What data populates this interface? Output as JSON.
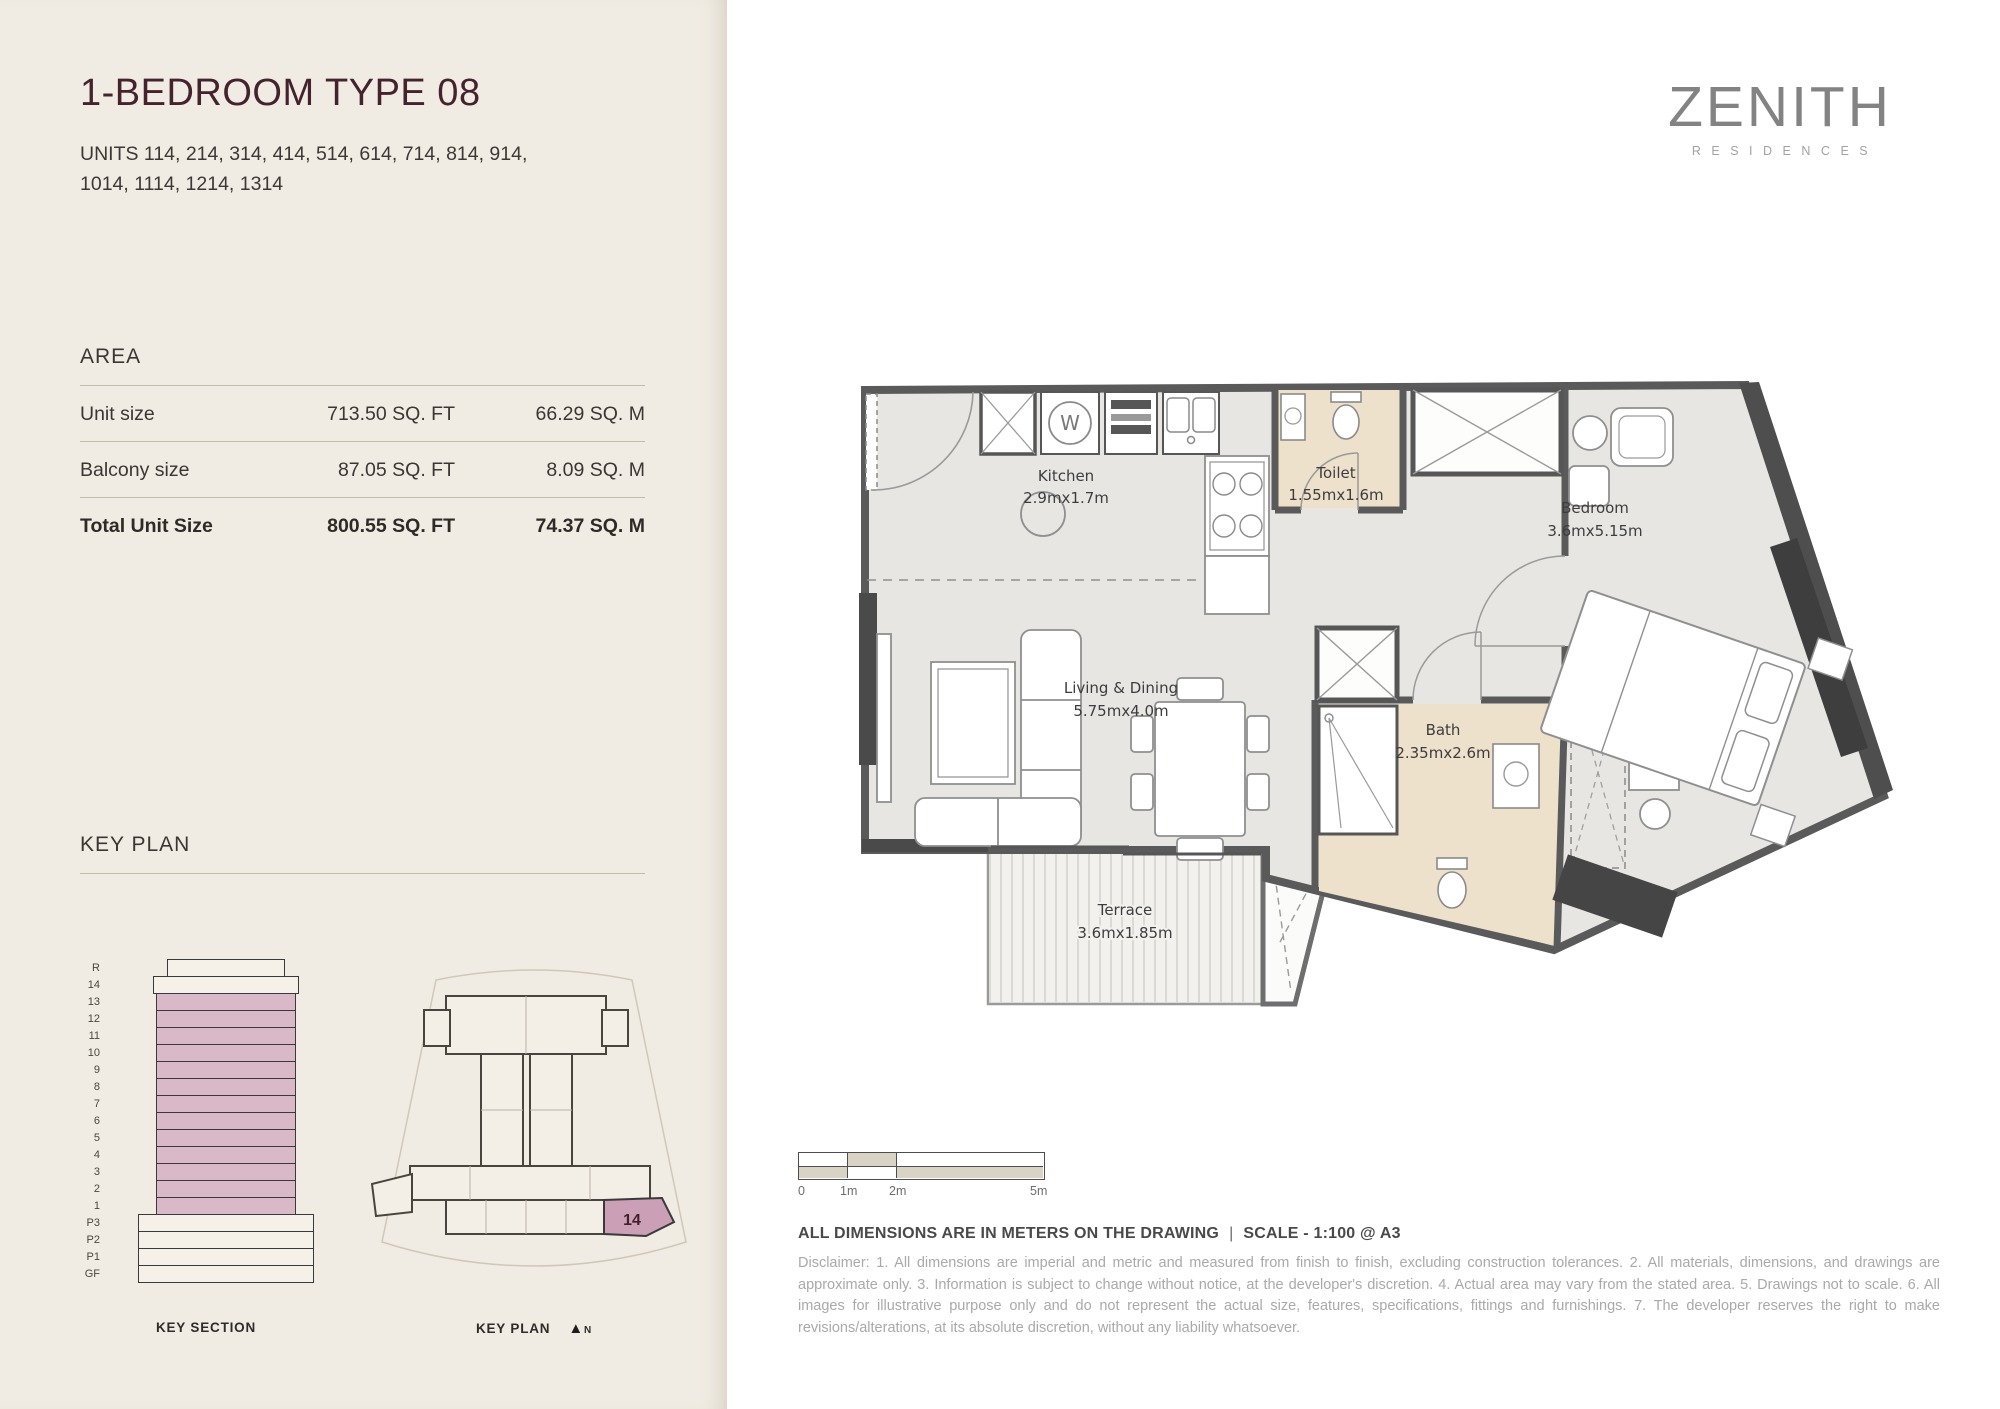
{
  "header": {
    "title": "1-BEDROOM TYPE 08",
    "units_line1": "UNITS 114, 214, 314, 414, 514, 614, 714, 814, 914,",
    "units_line2": "1014, 1114, 1214, 1314"
  },
  "brand": {
    "name": "ZENITH",
    "subtitle": "RESIDENCES"
  },
  "area": {
    "heading": "AREA",
    "rows": [
      {
        "label": "Unit size",
        "sqft": "713.50 SQ. FT",
        "sqm": "66.29 SQ. M"
      },
      {
        "label": "Balcony size",
        "sqft": "87.05 SQ. FT",
        "sqm": "8.09 SQ. M"
      },
      {
        "label": "Total Unit Size",
        "sqft": "800.55 SQ. FT",
        "sqm": "74.37 SQ. M"
      }
    ]
  },
  "key_plan_section": {
    "heading": "KEY PLAN",
    "key_section_label": "KEY SECTION",
    "key_plan_label": "KEY PLAN",
    "north_label": "N",
    "floors": [
      "R",
      "14",
      "13",
      "12",
      "11",
      "10",
      "9",
      "8",
      "7",
      "6",
      "5",
      "4",
      "3",
      "2",
      "1",
      "P3",
      "P2",
      "P1",
      "GF"
    ],
    "highlighted_floors": [
      "13",
      "12",
      "11",
      "10",
      "9",
      "8",
      "7",
      "6",
      "5",
      "4",
      "3",
      "2",
      "1"
    ],
    "highlighted_unit": "14"
  },
  "plan": {
    "rooms": [
      {
        "name": "Kitchen",
        "dims": "2.9mx1.7m"
      },
      {
        "name": "Toilet",
        "dims": "1.55mx1.6m"
      },
      {
        "name": "Living & Dining",
        "dims": "5.75mx4.0m"
      },
      {
        "name": "Bath",
        "dims": "2.35mx2.6m"
      },
      {
        "name": "Bedroom",
        "dims": "3.6mx5.15m"
      },
      {
        "name": "Terrace",
        "dims": "3.6mx1.85m"
      }
    ]
  },
  "icons": {
    "washer": "W",
    "north_arrow": "▲"
  },
  "scale_bar": {
    "labels": [
      "0",
      "1m",
      "2m",
      "5m"
    ]
  },
  "footer": {
    "dimensions_note": "ALL DIMENSIONS ARE IN METERS ON THE DRAWING",
    "separator": "|",
    "scale_note": "SCALE - 1:100 @ A3",
    "disclaimer": "Disclaimer: 1. All dimensions are imperial and metric and measured from finish to finish, excluding construction tolerances. 2. All materials, dimensions, and drawings are approximate only. 3. Information is subject to change without notice, at the developer's discretion. 4. Actual area may vary from the stated area. 5. Drawings not to scale. 6. All images for illustrative purpose only and do not represent the actual size, features, specifications, fittings and furnishings. 7. The developer reserves the right to make revisions/alterations, at its absolute discretion, without any liability whatsoever."
  },
  "colors": {
    "sidebar_bg": "#f1ece3",
    "accent_maroon": "#44232e",
    "floor_pink": "#d9b9c7",
    "unit_pink": "#cb9fb5",
    "wet_room_beige": "#ede1cc",
    "plan_floor": "#e7e6e3",
    "wall_gray": "#5a5a5a",
    "disclaimer_gray": "#a9a9a9"
  }
}
